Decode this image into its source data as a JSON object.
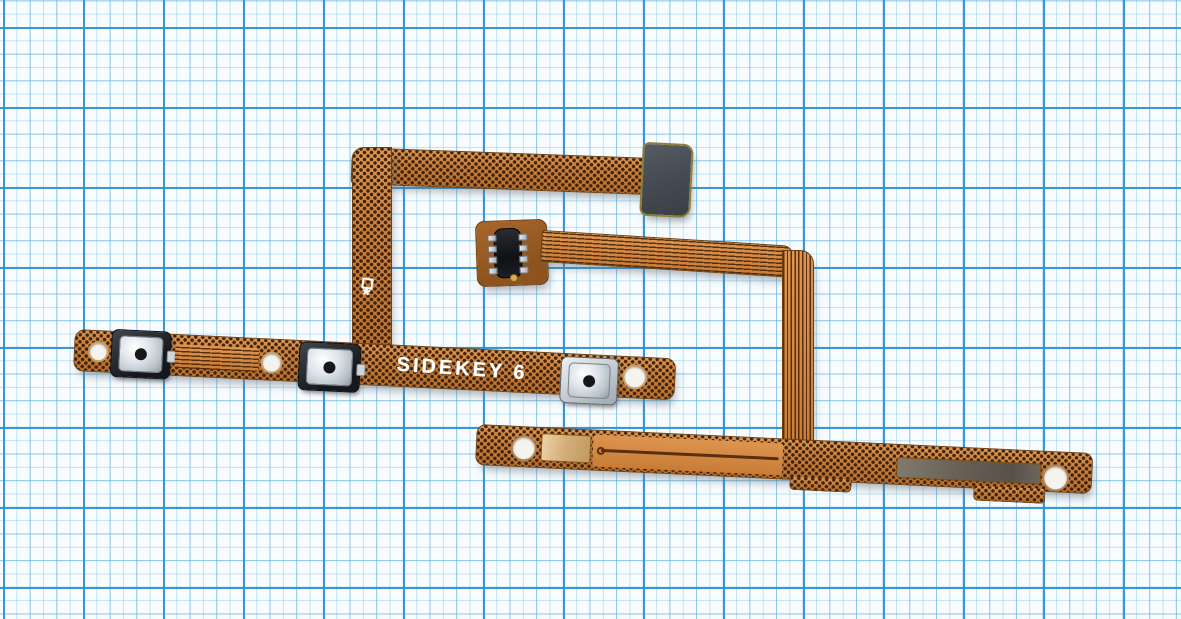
{
  "meta": {
    "scene": "product-photo",
    "subject": "Mobile phone side-key (power / volume) button flex cable with bracket, laid on blue graph paper",
    "photo_has_no_ui_text_except_silkscreen": true
  },
  "background": {
    "kind": "graph-paper",
    "paper_color": "#f8fcfe",
    "minor_line_color": "#8cd0ec",
    "major_line_color": "#2f8fd0",
    "minor_spacing_px": 13.33,
    "major_spacing_px": 80
  },
  "sidekey_flex": {
    "silkscreen_text": "SIDEKEY 6",
    "marking_symbol": "*",
    "button_count": 3,
    "buttons": [
      "volume-up-switch",
      "volume-down-switch",
      "power-switch"
    ],
    "stiffener": "black connector stiffener pad",
    "colors": {
      "body": "#cd8440",
      "edge": "#6e4010",
      "perforation": "#40230a",
      "stiffener": "#474c54",
      "switch_frame": "#15171b",
      "switch_metal": "#dfe5ea"
    }
  },
  "bracket_flex": {
    "component": "side-switch contact component with silver pins",
    "solder_pads": 2,
    "alignment_holes": 3,
    "colors": {
      "body": "#cd8440",
      "trace": "#4a2608",
      "component_body": "#101114",
      "pin_metal": "#d7dbdf",
      "tarnished_pad": "#6a6257"
    }
  }
}
